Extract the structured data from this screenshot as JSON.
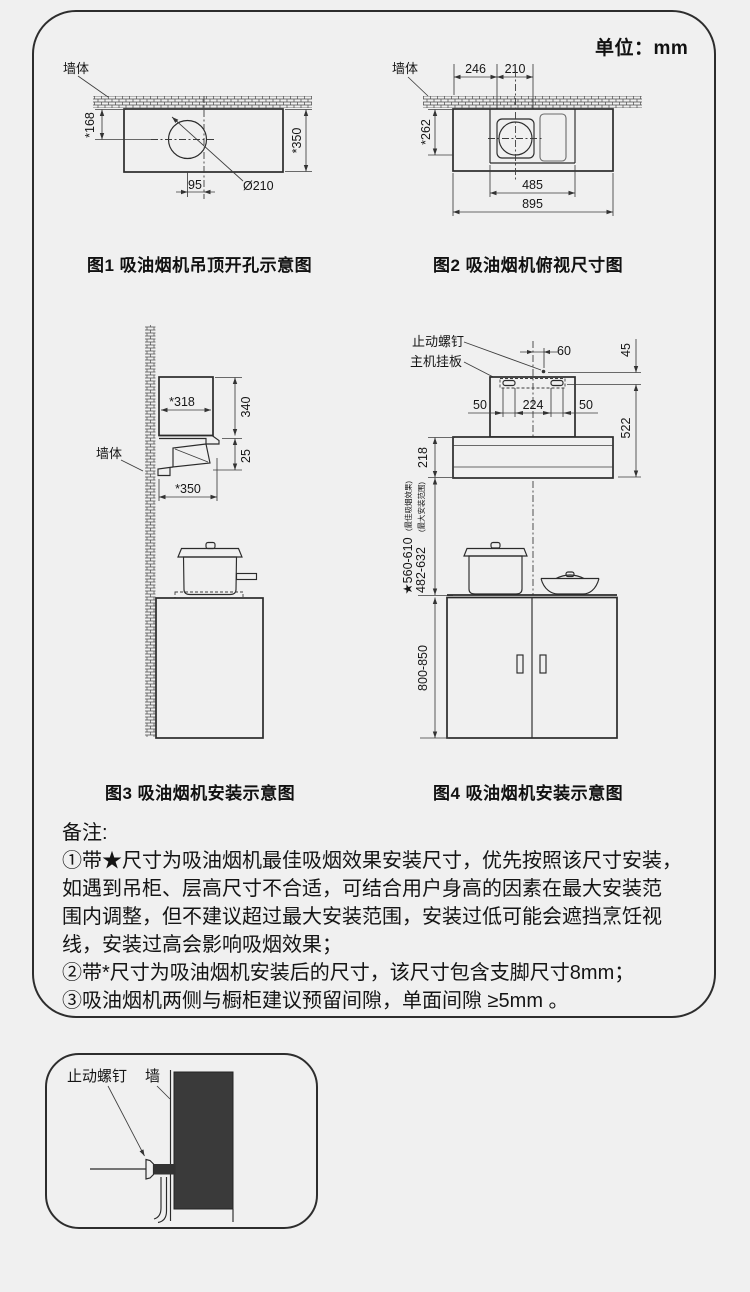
{
  "unit_label": "单位：mm",
  "colors": {
    "background": "#f0f0f0",
    "line": "#2b2b2b",
    "dim_line": "#3d3d3d",
    "panel_border": "#2d2d2d",
    "dark_fill": "#3a3a3a"
  },
  "figure1": {
    "caption": "图1 吸油烟机吊顶开孔示意图",
    "wall_label": "墙体",
    "dims": {
      "height_offset": "*168",
      "depth": "*350",
      "center_offset": "95",
      "hole_diameter": "Ø210"
    }
  },
  "figure2": {
    "caption": "图2 吸油烟机俯视尺寸图",
    "wall_label": "墙体",
    "dims": {
      "left_to_duct": "246",
      "duct_width": "210",
      "depth": "*262",
      "chimney_width": "485",
      "total_width": "895"
    }
  },
  "figure3": {
    "caption": "图3 吸油烟机安装示意图",
    "wall_label": "墙体",
    "dims": {
      "body_depth": "*318",
      "body_height": "340",
      "lip_height": "25",
      "canopy_depth": "*350"
    }
  },
  "figure4": {
    "caption": "图4 吸油烟机安装示意图",
    "labels": {
      "stop_screw": "止动螺钉",
      "hanging_plate": "主机挂板"
    },
    "dims": {
      "screw_offset": "60",
      "screw_to_plate": "45",
      "slot_left": "50",
      "slot_spacing": "224",
      "slot_right": "50",
      "total_height": "522",
      "body_height": "218",
      "best_range": "★560-610",
      "best_range_note": "(最佳吸烟效果)",
      "max_range": "482-632",
      "max_range_note": "(最大安装范围)",
      "cabinet_height": "800-850"
    }
  },
  "notes": {
    "title": "备注:",
    "lines": [
      "①带★尺寸为吸油烟机最佳吸烟效果安装尺寸，优先按照该尺寸安装，",
      "如遇到吊柜、层高尺寸不合适，可结合用户身高的因素在最大安装范",
      "围内调整，但不建议超过最大安装范围，安装过低可能会遮挡烹饪视",
      "线，安装过高会影响吸烟效果；",
      "②带*尺寸为吸油烟机安装后的尺寸，该尺寸包含支脚尺寸8mm；",
      "③吸油烟机两侧与橱柜建议预留间隙，单面间隙 ≥5mm 。"
    ]
  },
  "detail_panel": {
    "stop_screw_label": "止动螺钉",
    "wall_label": "墙"
  }
}
